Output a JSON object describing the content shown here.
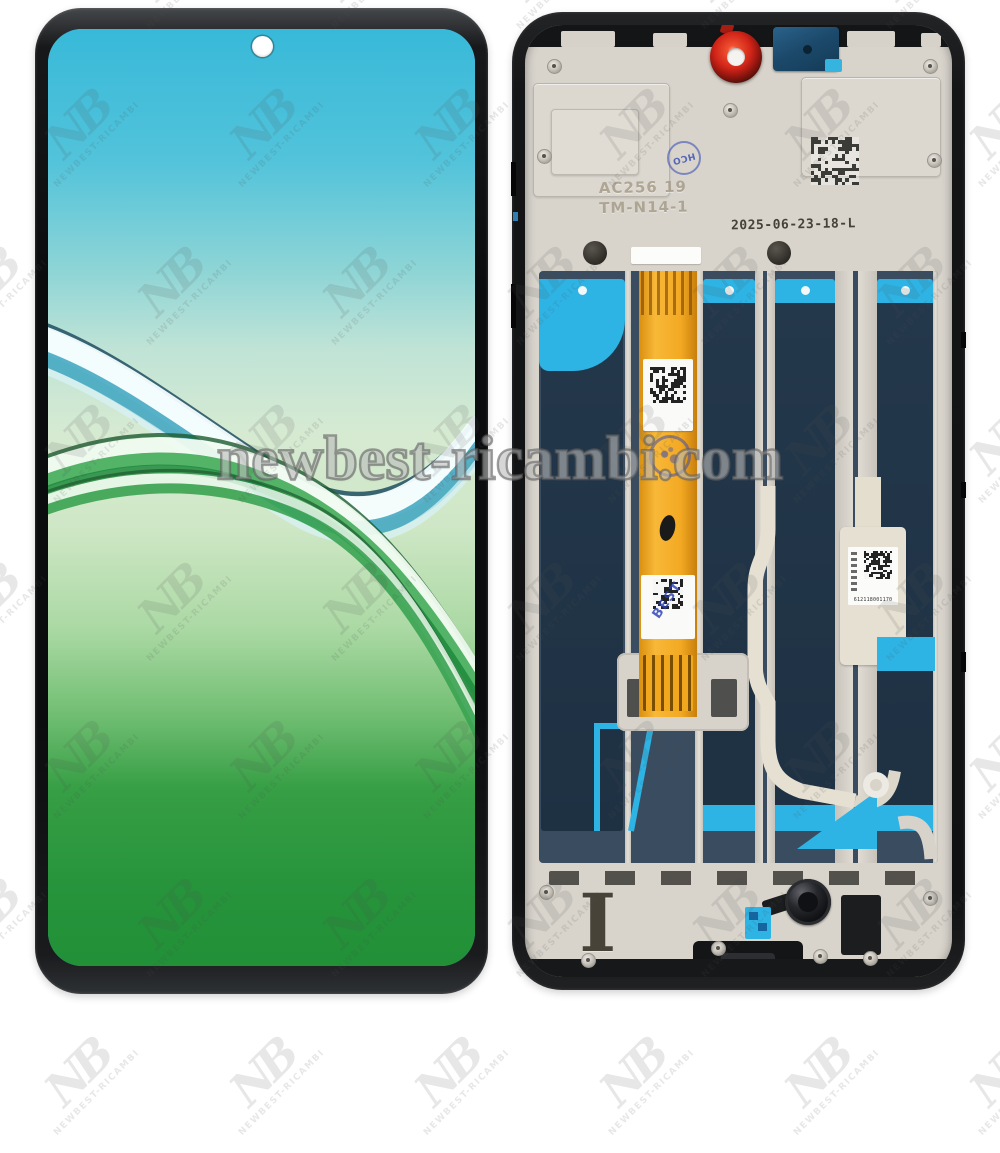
{
  "watermark": {
    "site": "newbest-ricambi.com",
    "monogram": "NB",
    "brand": "NEWBEST-RICAMBI"
  },
  "front": {
    "description": "phone display assembly front view",
    "wallpaper_top_color": "#38b9d9",
    "wallpaper_mid_color": "#d6ead2",
    "wallpaper_bottom_color": "#219037"
  },
  "back": {
    "description": "phone display assembly back view with frame",
    "stamp_circle": "HCO",
    "stamp_model_line1": "AC256 19",
    "stamp_model_line2": "TM-N14-1",
    "date_code": "2025-06-23-18-L",
    "flex_qc_stamp": "BEST",
    "label_serial": "612118001170",
    "frame_marking": "I"
  },
  "colors": {
    "adhesive_navy": "#1f3345",
    "adhesive_cyan": "#2db4e5",
    "flex_orange": "#f3a922",
    "camera_gasket_red": "#d02418",
    "camera_module_blue": "#1c4a6c",
    "metal_plate": "#d8d4cc",
    "frame_black": "#141517"
  }
}
